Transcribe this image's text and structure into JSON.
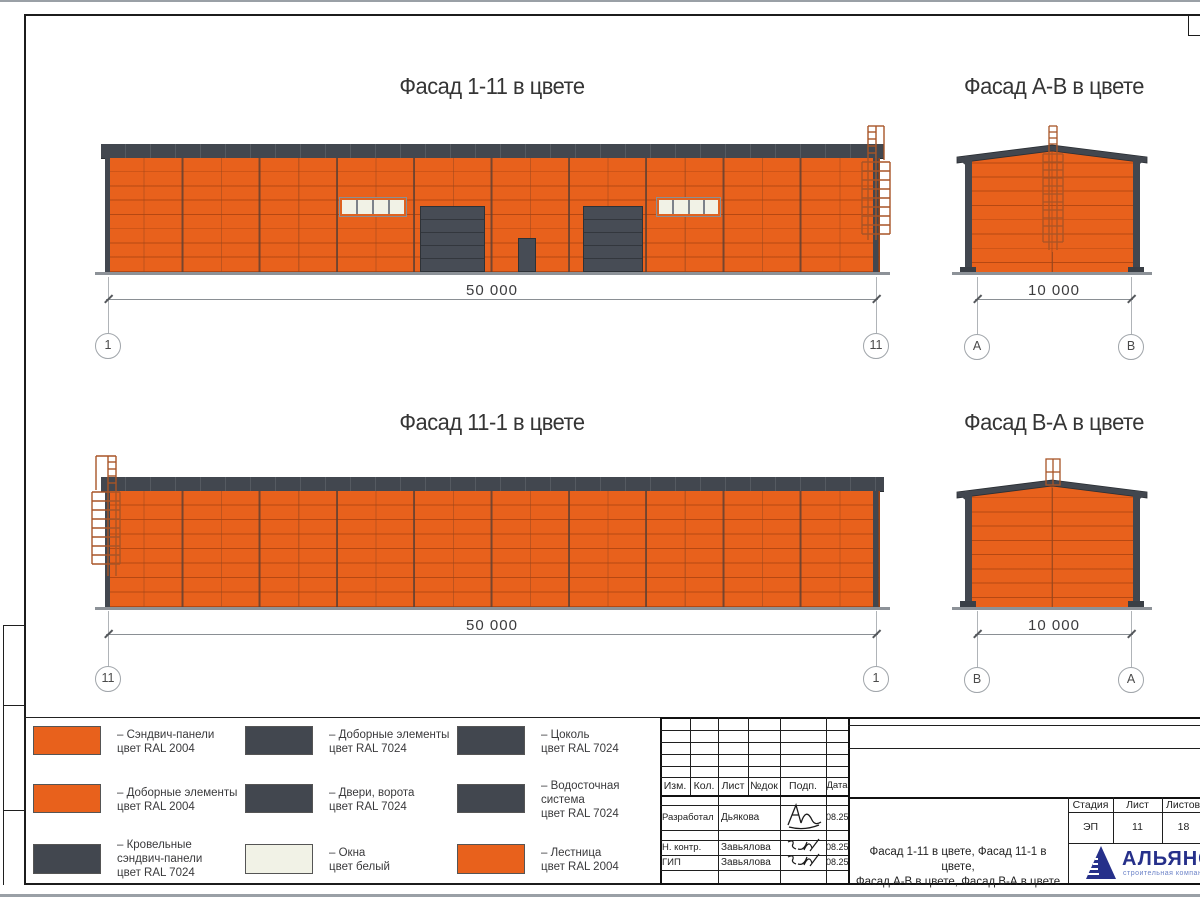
{
  "facades": [
    {
      "title": "Фасад 1-11 в цвете",
      "dim": "50 000",
      "grid_left": "1",
      "grid_right": "11"
    },
    {
      "title": "Фасад А-В в цвете",
      "dim": "10 000",
      "grid_left": "А",
      "grid_right": "В"
    },
    {
      "title": "Фасад 11-1 в цвете",
      "dim": "50 000",
      "grid_left": "11",
      "grid_right": "1"
    },
    {
      "title": "Фасад В-А в цвете",
      "dim": "10 000",
      "grid_left": "В",
      "grid_right": "А"
    }
  ],
  "legend": {
    "items": [
      {
        "label": "– Сэндвич-панели\nцвет RAL 2004",
        "color": "#e8611c"
      },
      {
        "label": "– Доборные элементы\nцвет RAL 2004",
        "color": "#e8611c"
      },
      {
        "label": "– Кровельные\nсэндвич-панели\nцвет RAL 7024",
        "color": "#42474f"
      },
      {
        "label": "– Доборные элементы\nцвет RAL 7024",
        "color": "#42474f"
      },
      {
        "label": "– Двери, ворота\nцвет RAL 7024",
        "color": "#42474f"
      },
      {
        "label": "– Окна\nцвет белый",
        "color": "#f1f2e6"
      },
      {
        "label": "– Цоколь\nцвет RAL 7024",
        "color": "#42474f"
      },
      {
        "label": "– Водосточная\nсистема\nцвет RAL 7024",
        "color": "#42474f"
      },
      {
        "label": "– Лестница\nцвет RAL 2004",
        "color": "#e8611c"
      }
    ]
  },
  "title_block": {
    "header_cols": [
      "Изм.",
      "Кол.",
      "Лист",
      "№док",
      "Подп.",
      "Дата"
    ],
    "staff": [
      {
        "role": "Разработал",
        "name": "Дьякова",
        "date": "08.25"
      },
      {
        "role": "Н. контр.",
        "name": "Завьялова",
        "date": "08.25"
      },
      {
        "role": "ГИП",
        "name": "Завьялова",
        "date": "08.25"
      }
    ],
    "stage_label": "Стадия",
    "sheet_label": "Лист",
    "sheets_label": "Листов",
    "stage": "ЭП",
    "sheet_no": "11",
    "sheets_total": "18",
    "doc_title": "Фасад 1-11 в цвете, Фасад 11-1 в цвете,\nФасад А-В в цвете, Фасад В-А в цвете",
    "company": {
      "name": "АЛЬЯНС",
      "tagline": "строительная компания"
    }
  },
  "colors": {
    "ral2004_orange": "#e8611c",
    "ral7024_graphite": "#42474f",
    "window_white": "#f1f2e6",
    "logo_navy": "#262e80",
    "logo_blue": "#6c83c8"
  }
}
